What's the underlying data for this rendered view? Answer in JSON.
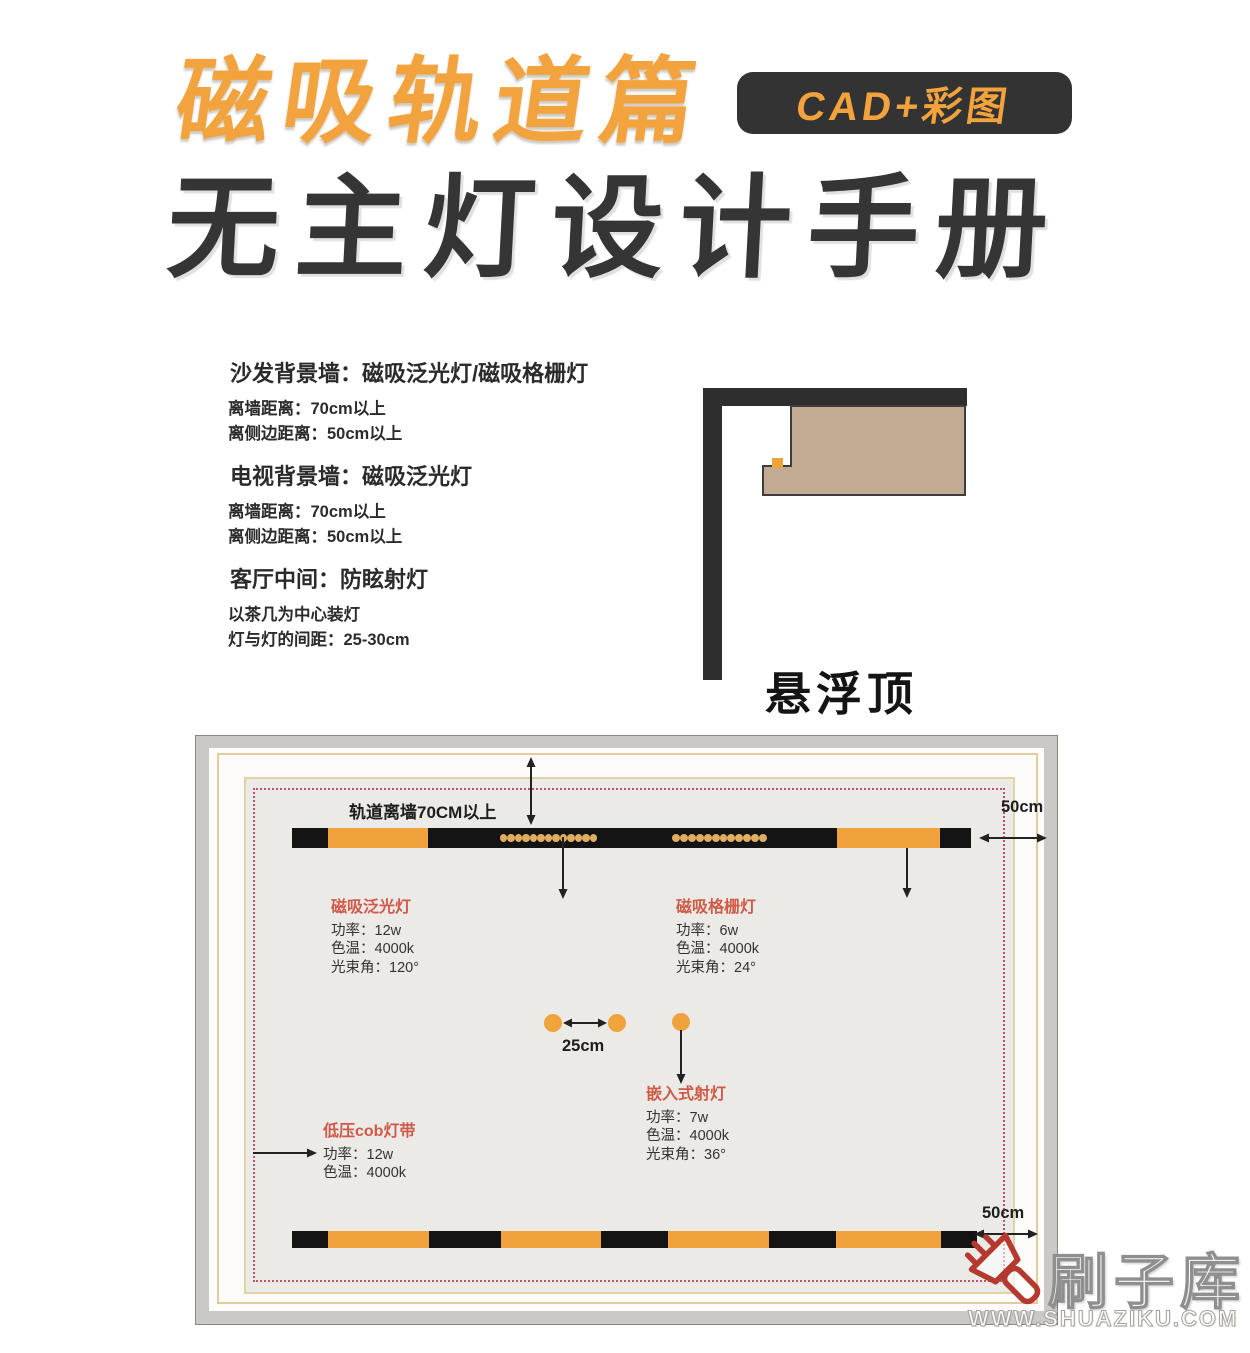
{
  "header": {
    "series_title": "磁吸轨道篇",
    "badge": "CAD+彩图",
    "main_title": "无主灯设计手册"
  },
  "colors": {
    "accent_orange": "#f2a33d",
    "title_dark": "#353535",
    "label_red": "#d05a48",
    "track_orange": "#f0a23c",
    "track_black": "#141414",
    "dot_orange": "#dfae60",
    "tan": "#c3ab93",
    "panel_gray": "#ebeae7",
    "dotted_red": "#c4506a",
    "frame_gray": "#cbc9c6"
  },
  "info_sections": [
    {
      "title": "沙发背景墙：磁吸泛光灯/磁吸格栅灯",
      "lines": [
        "离墙距离：70cm以上",
        "离侧边距离：50cm以上"
      ]
    },
    {
      "title": "电视背景墙：磁吸泛光灯",
      "lines": [
        "离墙距离：70cm以上",
        "离侧边距离：50cm以上"
      ]
    },
    {
      "title": "客厅中间：防眩射灯",
      "lines": [
        "以茶几为中心装灯",
        "灯与灯的间距：25-30cm"
      ]
    }
  ],
  "ceiling": {
    "label": "悬浮顶"
  },
  "plan": {
    "wall_note": "轨道离墙70CM以上",
    "top_right_dim": "50cm",
    "bottom_right_dim": "50cm",
    "spot_spacing": "25cm",
    "specs": [
      {
        "title": "磁吸泛光灯",
        "lines": [
          "功率：12w",
          "色温：4000k",
          "光束角：120°"
        ]
      },
      {
        "title": "磁吸格栅灯",
        "lines": [
          "功率：6w",
          "色温：4000k",
          "光束角：24°"
        ]
      },
      {
        "title": "嵌入式射灯",
        "lines": [
          "功率：7w",
          "色温：4000k",
          "光束角：36°"
        ]
      },
      {
        "title": "低压cob灯带",
        "lines": [
          "功率：12w",
          "色温：4000k"
        ]
      }
    ],
    "tracks": {
      "top": {
        "left": 96,
        "top": 92,
        "width": 679,
        "height": 20,
        "segments": [
          {
            "color": "black",
            "width": 36
          },
          {
            "color": "orange",
            "width": 100
          },
          {
            "color": "black",
            "width": 409
          },
          {
            "color": "orange",
            "width": 103
          },
          {
            "color": "black",
            "width": 31
          }
        ],
        "dot_groups": [
          {
            "offset": 205,
            "span": 103,
            "count": 13
          },
          {
            "offset": 377,
            "span": 101,
            "count": 12
          }
        ]
      },
      "bottom": {
        "left": 96,
        "top": 495,
        "width": 685,
        "height": 17,
        "segments": [
          {
            "color": "black",
            "width": 36
          },
          {
            "color": "orange",
            "width": 101
          },
          {
            "color": "black",
            "width": 72
          },
          {
            "color": "orange",
            "width": 100
          },
          {
            "color": "black",
            "width": 67
          },
          {
            "color": "orange",
            "width": 101
          },
          {
            "color": "black",
            "width": 67
          },
          {
            "color": "orange",
            "width": 105
          },
          {
            "color": "black",
            "width": 36
          }
        ],
        "dot_groups": []
      }
    },
    "spots": [
      {
        "left": 348,
        "top": 278
      },
      {
        "left": 412,
        "top": 278
      },
      {
        "left": 476,
        "top": 277
      }
    ]
  },
  "watermark": {
    "name": "刷子库",
    "url": "WWW.SHUAZIKU.COM"
  }
}
